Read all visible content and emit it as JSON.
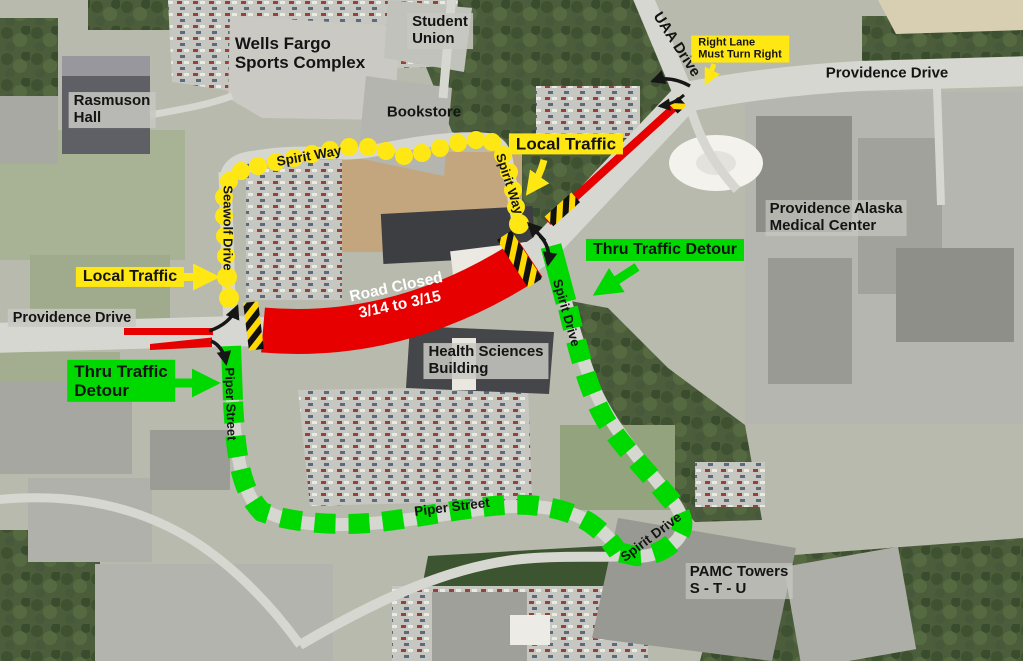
{
  "colors": {
    "road_closed_red": "#e60000",
    "local_traffic_yellow": "#ffe714",
    "detour_green": "#00d900"
  },
  "labels": {
    "wells_fargo_sports_complex": "Wells Fargo\nSports Complex",
    "student_union": "Student\nUnion",
    "rasmuson_hall": "Rasmuson\nHall",
    "bookstore": "Bookstore",
    "uaa_drive": "UAA Drive",
    "right_lane_must_turn_right": "Right Lane\nMust Turn Right",
    "providence_drive_right": "Providence Drive",
    "providence_drive_left": "Providence Drive",
    "providence_alaska_medical_center": "Providence Alaska\nMedical Center",
    "local_traffic_top": "Local Traffic",
    "local_traffic_left": "Local Traffic",
    "thru_traffic_detour_right": "Thru Traffic Detour",
    "thru_traffic_detour_left": "Thru Traffic\nDetour",
    "road_closed": "Road Closed\n3/14 to 3/15",
    "health_sciences_building": "Health Sciences\nBuilding",
    "seawolf_drive": "Seawolf Drive",
    "spirit_way_top": "Spirit Way",
    "spirit_way_east": "Spirit Way",
    "spirit_drive_upper": "Spirit Drive",
    "spirit_drive_lower": "Spirit Drive",
    "piper_street_upper": "Piper Street",
    "piper_street_lower": "Piper Street",
    "pamc_towers": "PAMC Towers\nS - T - U"
  }
}
